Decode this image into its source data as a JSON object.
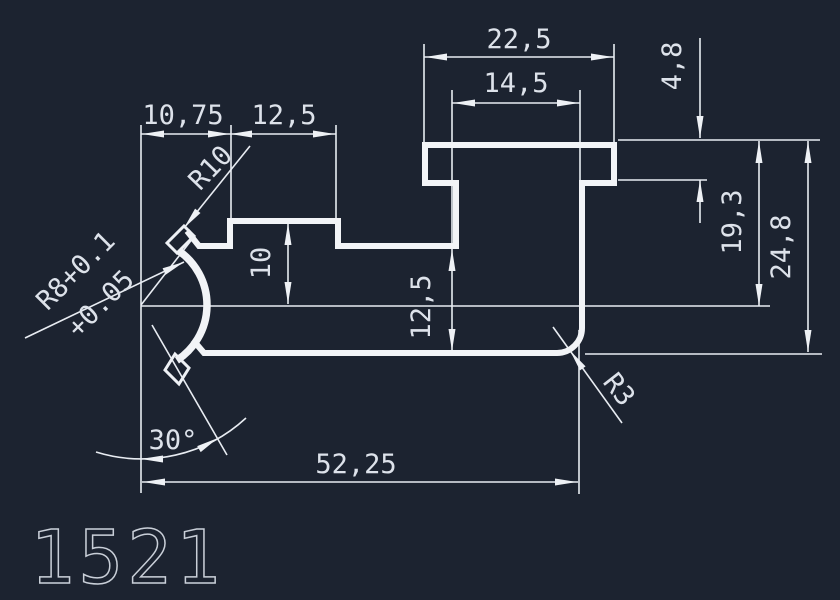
{
  "drawing": {
    "part_number": "1521",
    "dims": {
      "top_outer": "22,5",
      "top_inner": "14,5",
      "hat_height": "4,8",
      "left_a": "10,75",
      "left_b": "12,5",
      "notch": "10",
      "web": "12,5",
      "right_inner": "19,3",
      "right_outer": "24,8",
      "overall": "52,25",
      "angle": "30°",
      "radius_r10": "R10",
      "radius_r8_line1": "R8+0.1",
      "radius_r8_line2": "+0.05",
      "fillet_r3": "R3"
    },
    "colors": {
      "background": "#1c2330",
      "line": "#f2f4f7",
      "text": "#dde2ea"
    }
  }
}
